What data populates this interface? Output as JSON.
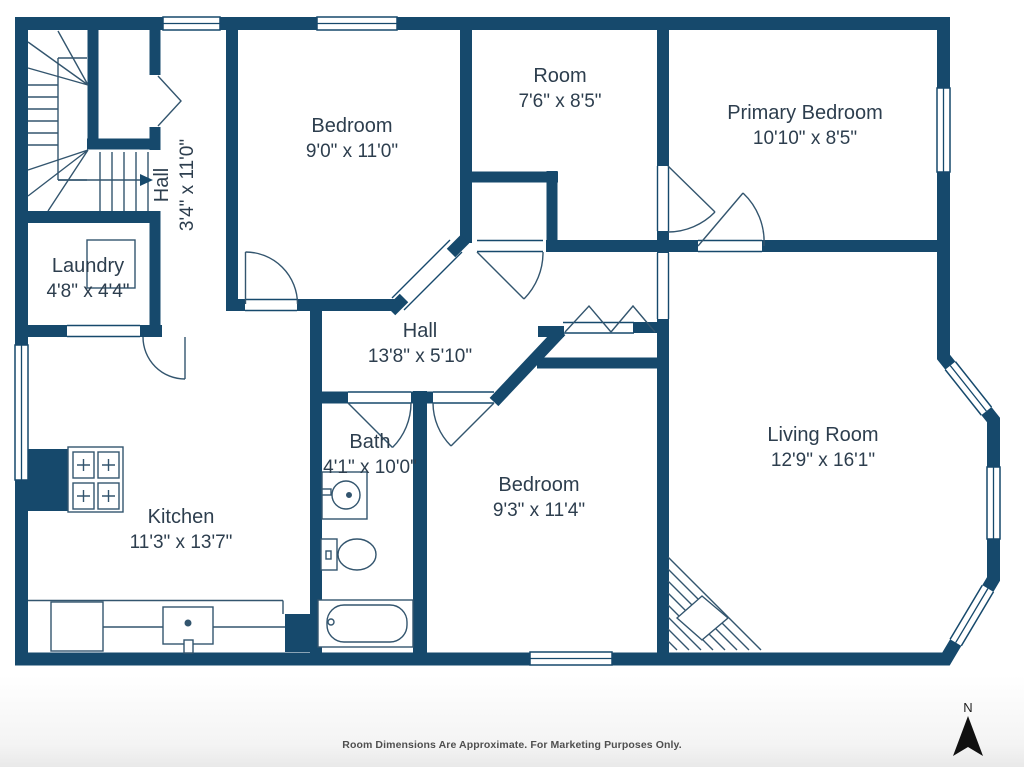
{
  "plan": {
    "rooms": {
      "bedroom1": {
        "name": "Bedroom",
        "dims": "9'0\" x 11'0\""
      },
      "room": {
        "name": "Room",
        "dims": "7'6\" x 8'5\""
      },
      "primary": {
        "name": "Primary Bedroom",
        "dims": "10'10\" x 8'5\""
      },
      "hall_upper": {
        "name": "Hall",
        "dims": "3'4\" x 11'0\""
      },
      "laundry": {
        "name": "Laundry",
        "dims": "4'8\" x 4'4\""
      },
      "hall_main": {
        "name": "Hall",
        "dims": "13'8\" x 5'10\""
      },
      "bath": {
        "name": "Bath",
        "dims": "4'1\" x 10'0\""
      },
      "bedroom2": {
        "name": "Bedroom",
        "dims": "9'3\" x 11'4\""
      },
      "kitchen": {
        "name": "Kitchen",
        "dims": "11'3\" x 13'7\""
      },
      "living": {
        "name": "Living Room",
        "dims": "12'9\" x 16'1\""
      }
    },
    "compass": {
      "label": "N"
    },
    "footer": "Room Dimensions Are Approximate. For Marketing Purposes Only.",
    "colors": {
      "wall": "#16496C",
      "label_text": "#2D3E4E",
      "footer_text": "#4F4F4F",
      "compass": "#111111"
    }
  }
}
